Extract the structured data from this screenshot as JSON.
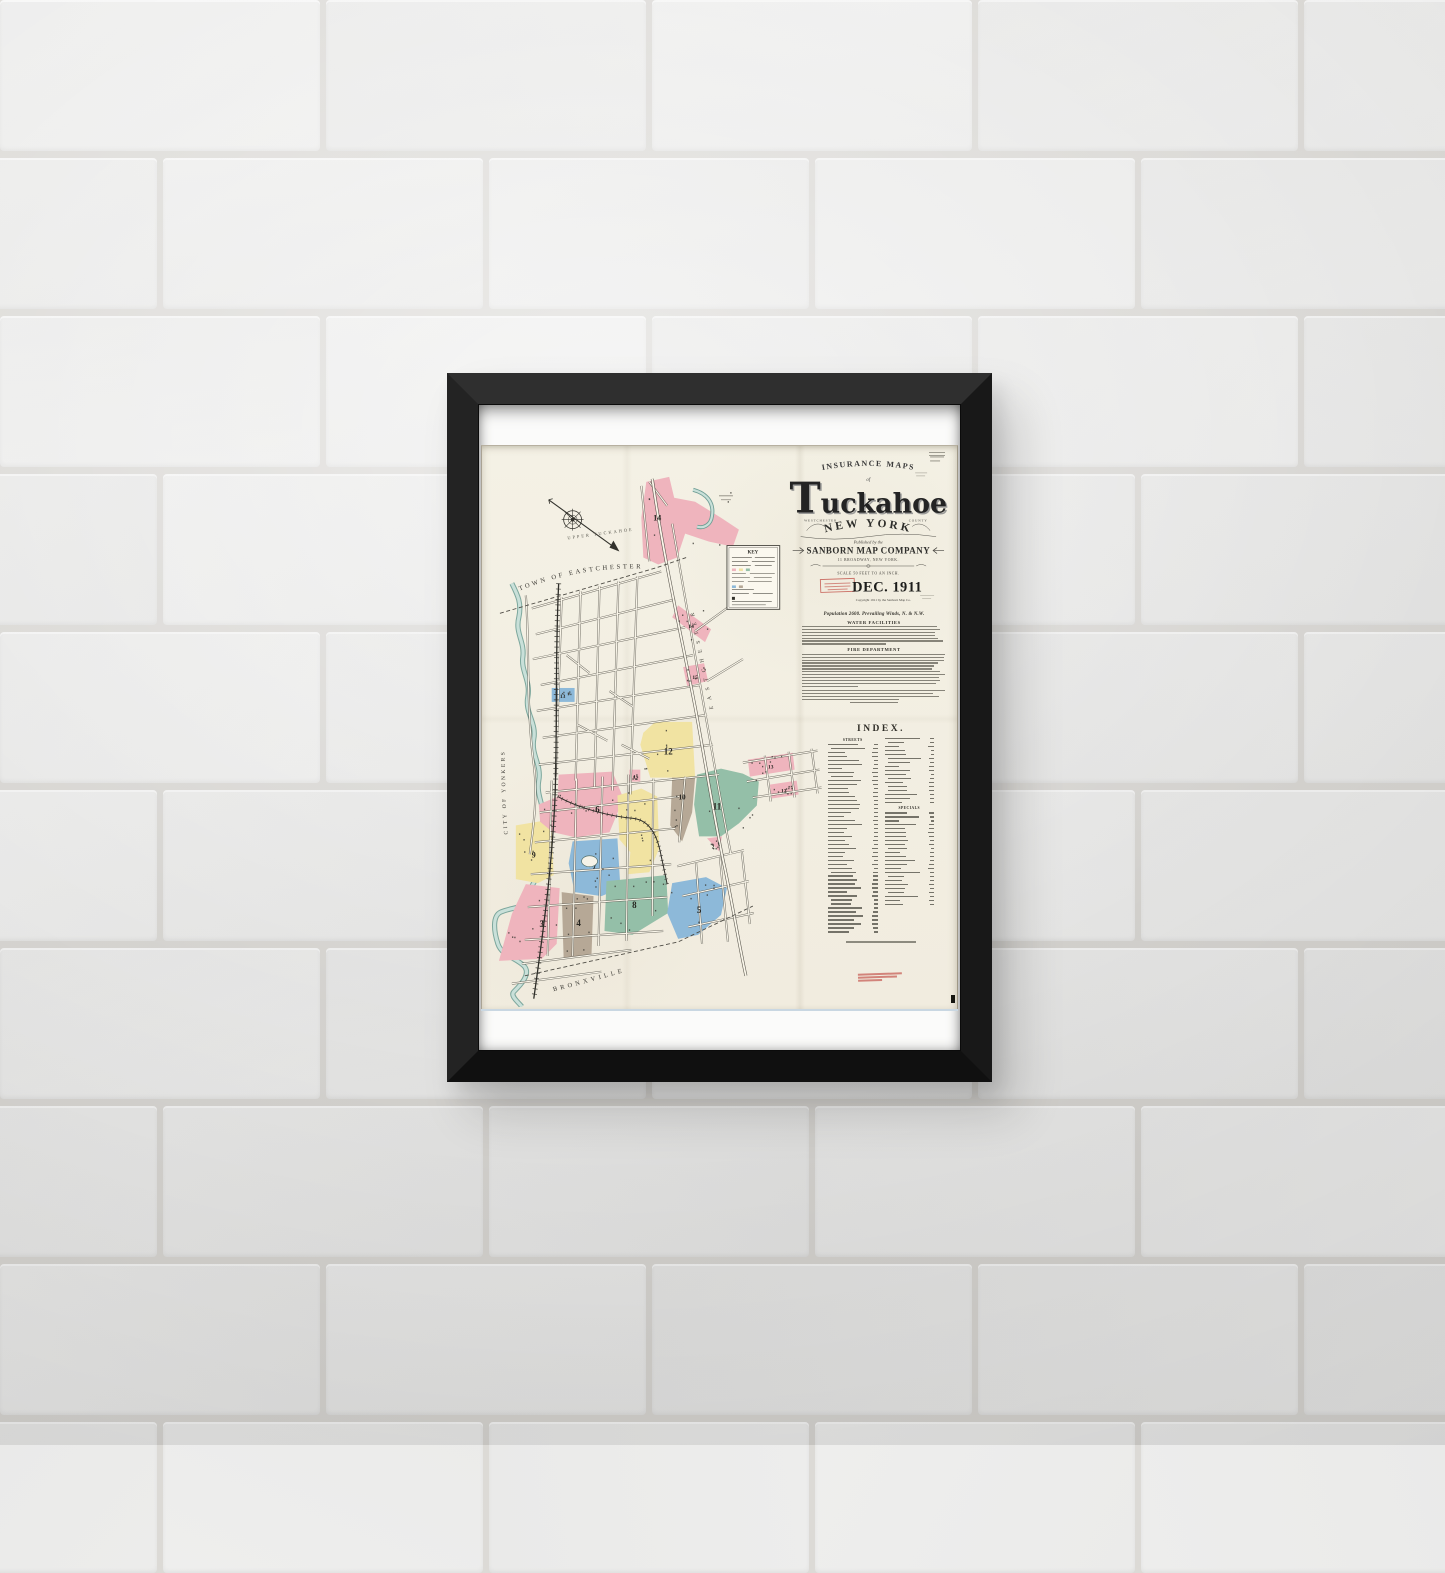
{
  "scene": {
    "description": "Framed Sanborn fire insurance map poster hanging on a white painted brick wall"
  },
  "title_block": {
    "series": "INSURANCE MAPS",
    "of": "of",
    "title_initial": "T",
    "title_rest": "uckahoe",
    "county_left": "WESTCHESTER",
    "county_right": "COUNTY",
    "state": "NEW YORK",
    "published_by": "Published by the",
    "company": "SANBORN MAP COMPANY",
    "address": "11 BROADWAY, NEW YORK.",
    "scale": "SCALE 50 FEET TO AN INCH.",
    "date": "DEC. 1911",
    "copyright": "Copyright 1911 by the Sanborn Map Co."
  },
  "stats": {
    "population": "Population 2600. Prevailing Winds, N. & N.W.",
    "water_heading": "WATER FACILITIES",
    "fire_heading": "FIRE DEPARTMENT"
  },
  "index": {
    "title": "INDEX.",
    "streets_heading": "STREETS",
    "specials_heading": "SPECIALS"
  },
  "map": {
    "key_title": "KEY",
    "labels": {
      "town": "TOWN OF EASTCHESTER",
      "city": "CITY OF YONKERS",
      "village": "BRONXVILLE",
      "upper": "UPPER TUCKAHOE",
      "road": "EASTCHESTER"
    },
    "colors": {
      "pink": "#efb4bd",
      "yellow": "#f1e3a2",
      "green": "#94bfa8",
      "blue": "#8db9d9",
      "brown": "#b6a896",
      "river": "#9fc6bc"
    },
    "districts": [
      {
        "label": "14"
      },
      {
        "label": "14"
      },
      {
        "label": "15"
      },
      {
        "label": "13"
      },
      {
        "label": "1"
      },
      {
        "label": "12"
      },
      {
        "label": "10"
      },
      {
        "label": "11"
      },
      {
        "label": "2"
      },
      {
        "label": "6"
      },
      {
        "label": "7"
      },
      {
        "label": "9"
      },
      {
        "label": "3"
      },
      {
        "label": "4"
      },
      {
        "label": "8"
      },
      {
        "label": "5"
      },
      {
        "label": "13"
      },
      {
        "label": "12"
      }
    ]
  }
}
